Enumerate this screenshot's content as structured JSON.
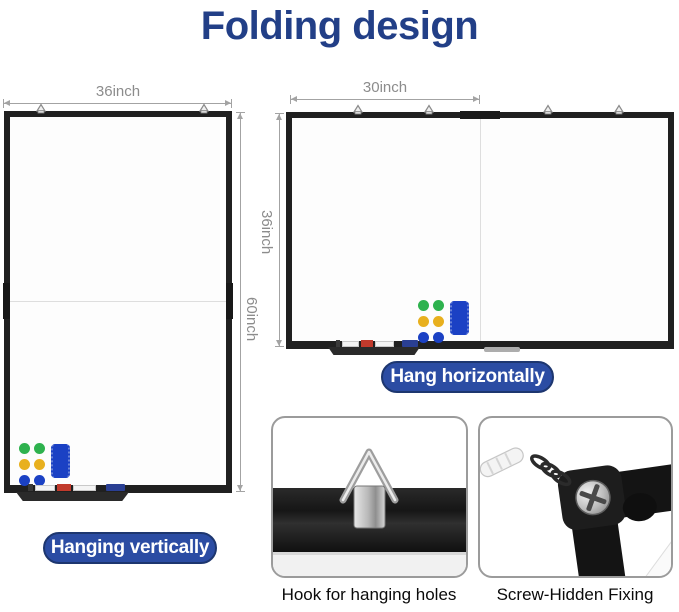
{
  "title": "Folding design",
  "colors": {
    "title": "#223f87",
    "pill_bg": "#2b4ca3",
    "dim_text": "#8c8c8c",
    "magnet_green": "#2eb24e",
    "magnet_yellow": "#e8b01e",
    "magnet_blue": "#1b41c4",
    "eraser_blue": "#1b41c4",
    "marker_red": "#c13a2c",
    "marker_dark": "#3a3a3a",
    "marker_blue": "#2a3f93",
    "caption_text": "#0a0a0a"
  },
  "vertical_board": {
    "width_label": "36inch",
    "height_label": "60inch",
    "caption": "Hanging vertically"
  },
  "horizontal_board": {
    "width_label": "30inch",
    "height_label": "36inch",
    "caption": "Hang horizontally"
  },
  "details": {
    "hook": {
      "caption": "Hook for hanging holes"
    },
    "screw": {
      "caption": "Screw-Hidden Fixing"
    }
  }
}
